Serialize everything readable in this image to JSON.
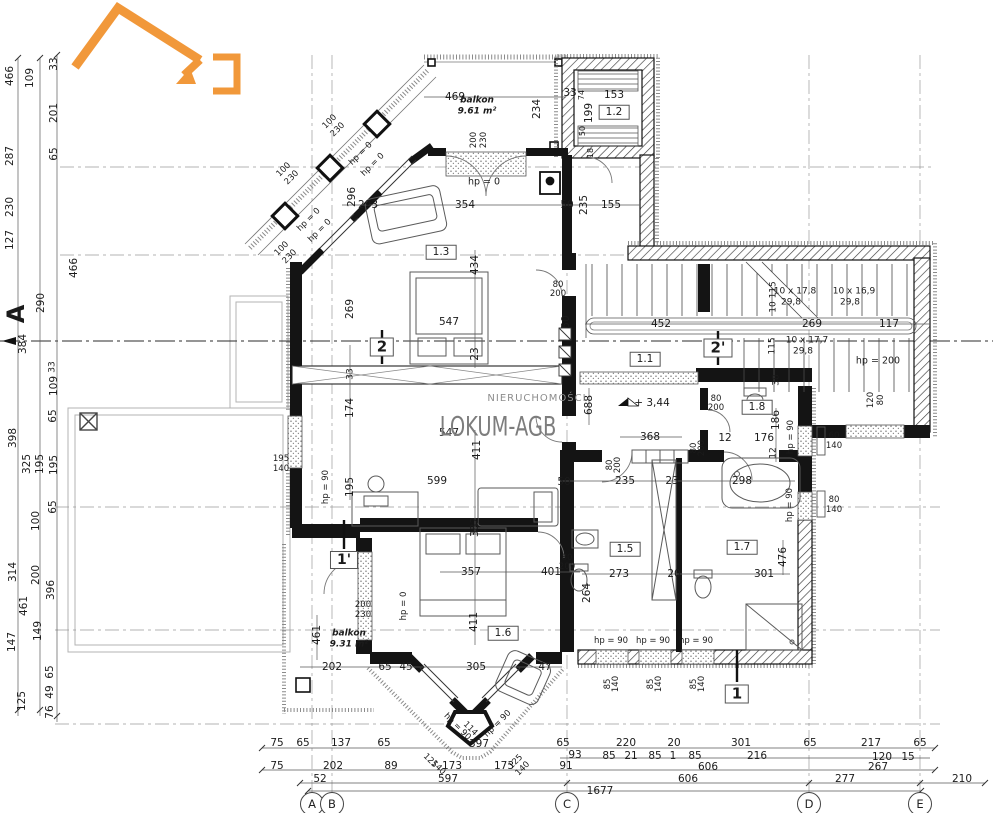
{
  "drawing": {
    "type": "apartment floor plan",
    "brand": {
      "name": "LOKUM-AGB",
      "subtitle": "NIERUCHOMOŚCI",
      "accent_color": "#f08a1f"
    },
    "grid_bubbles": [
      {
        "t": "A",
        "x": 312
      },
      {
        "t": "B",
        "x": 332
      },
      {
        "t": "C",
        "x": 567
      },
      {
        "t": "D",
        "x": 809
      },
      {
        "t": "E",
        "x": 920
      }
    ],
    "grid_bubble_y": 804,
    "labels": [
      {
        "t": "469",
        "x": 455,
        "y": 97
      },
      {
        "t": "234",
        "x": 537,
        "y": 109,
        "r": -90
      },
      {
        "t": "33",
        "x": 570,
        "y": 93
      },
      {
        "t": "74",
        "x": 582,
        "y": 95,
        "r": -90,
        "s": 8
      },
      {
        "t": "153",
        "x": 614,
        "y": 95
      },
      {
        "t": "199",
        "x": 589,
        "y": 113,
        "r": -90
      },
      {
        "t": "50",
        "x": 583,
        "y": 131,
        "r": -90,
        "s": 8
      },
      {
        "t": "18",
        "x": 591,
        "y": 153,
        "r": -90,
        "s": 8
      },
      {
        "t": "balkon",
        "x": 477,
        "y": 101,
        "b": 1,
        "i": 1,
        "s": 9,
        "n": "balcony-label"
      },
      {
        "t": "9.61 m²",
        "x": 477,
        "y": 112,
        "b": 1,
        "i": 1,
        "s": 9,
        "n": "balcony-area"
      },
      {
        "t": "200",
        "x": 474,
        "y": 140,
        "r": -90,
        "s": 8.5
      },
      {
        "t": "230",
        "x": 484,
        "y": 140,
        "r": -90,
        "s": 8.5
      },
      {
        "t": "hp = 0",
        "x": 484,
        "y": 182,
        "s": 9.5
      },
      {
        "t": "296",
        "x": 352,
        "y": 197,
        "r": -90
      },
      {
        "t": "293",
        "x": 368,
        "y": 205
      },
      {
        "t": "354",
        "x": 465,
        "y": 205
      },
      {
        "t": "50",
        "x": 567,
        "y": 205
      },
      {
        "t": "235",
        "x": 584,
        "y": 205,
        "r": -90
      },
      {
        "t": "155",
        "x": 611,
        "y": 205
      },
      {
        "t": "100",
        "x": 330,
        "y": 122,
        "r": -45,
        "s": 8.5
      },
      {
        "t": "230",
        "x": 338,
        "y": 130,
        "r": -45,
        "s": 8.5
      },
      {
        "t": "100",
        "x": 284,
        "y": 170,
        "r": -45,
        "s": 8.5
      },
      {
        "t": "230",
        "x": 292,
        "y": 178,
        "r": -45,
        "s": 8.5
      },
      {
        "t": "100",
        "x": 282,
        "y": 249,
        "r": -45,
        "s": 8.5
      },
      {
        "t": "230",
        "x": 290,
        "y": 257,
        "r": -45,
        "s": 8.5
      },
      {
        "t": "hp = 0",
        "x": 361,
        "y": 154,
        "r": -45,
        "s": 8.5
      },
      {
        "t": "hp = 0",
        "x": 373,
        "y": 165,
        "r": -45,
        "s": 8.5
      },
      {
        "t": "hp = 0",
        "x": 309,
        "y": 220,
        "r": -45,
        "s": 8.5
      },
      {
        "t": "hp = 0",
        "x": 320,
        "y": 231,
        "r": -45,
        "s": 8.5
      },
      {
        "t": "1.3",
        "x": 441,
        "y": 252,
        "box": 1,
        "n": "room-label"
      },
      {
        "t": "434",
        "x": 475,
        "y": 265,
        "r": -90
      },
      {
        "t": "269",
        "x": 350,
        "y": 309,
        "r": -90
      },
      {
        "t": "547",
        "x": 449,
        "y": 322
      },
      {
        "t": "23",
        "x": 475,
        "y": 354,
        "r": -90
      },
      {
        "t": "80",
        "x": 558,
        "y": 285,
        "s": 8.5
      },
      {
        "t": "200",
        "x": 558,
        "y": 294,
        "s": 8.5
      },
      {
        "t": "50",
        "x": 566,
        "y": 322,
        "r": -90
      },
      {
        "t": "452",
        "x": 661,
        "y": 324
      },
      {
        "t": "10 x 17,8",
        "x": 795,
        "y": 292,
        "s": 9,
        "n": "stair-note"
      },
      {
        "t": "29,8",
        "x": 791,
        "y": 303,
        "s": 9,
        "n": "stair-note"
      },
      {
        "t": "10 x 16,9",
        "x": 854,
        "y": 292,
        "s": 9,
        "n": "stair-note"
      },
      {
        "t": "29,8",
        "x": 850,
        "y": 303,
        "s": 9,
        "n": "stair-note"
      },
      {
        "t": "10 115",
        "x": 774,
        "y": 297,
        "r": -90,
        "s": 9
      },
      {
        "t": "269",
        "x": 812,
        "y": 324
      },
      {
        "t": "117",
        "x": 889,
        "y": 324
      },
      {
        "t": "10 x 17,7",
        "x": 807,
        "y": 341,
        "s": 9,
        "n": "stair-note"
      },
      {
        "t": "29,8",
        "x": 803,
        "y": 352,
        "s": 9,
        "n": "stair-note"
      },
      {
        "t": "115",
        "x": 773,
        "y": 346,
        "r": -90,
        "s": 9
      },
      {
        "t": "hp = 200",
        "x": 878,
        "y": 361,
        "s": 9.5
      },
      {
        "t": "38",
        "x": 777,
        "y": 380,
        "r": -90,
        "s": 9
      },
      {
        "t": "120",
        "x": 871,
        "y": 400,
        "r": -90,
        "s": 8.5
      },
      {
        "t": "80",
        "x": 881,
        "y": 400,
        "r": -90,
        "s": 8.5
      },
      {
        "t": "1.1",
        "x": 645,
        "y": 359,
        "box": 1,
        "n": "room-label"
      },
      {
        "t": "1.2",
        "x": 614,
        "y": 112,
        "box": 1,
        "n": "room-label"
      },
      {
        "t": "2",
        "x": 382,
        "y": 347,
        "b": 1,
        "s": 15,
        "box": 1,
        "n": "section-marker"
      },
      {
        "t": "2'",
        "x": 718,
        "y": 348,
        "b": 1,
        "s": 15,
        "box": 1,
        "n": "section-marker"
      },
      {
        "t": "A",
        "x": 16,
        "y": 314,
        "r": -90,
        "s": 24,
        "b": 1,
        "n": "axis-label"
      },
      {
        "t": "290",
        "x": 41,
        "y": 303,
        "r": -90
      },
      {
        "t": "384",
        "x": 23,
        "y": 344,
        "r": -90
      },
      {
        "t": "33",
        "x": 53,
        "y": 367,
        "r": -90,
        "s": 9
      },
      {
        "t": "109",
        "x": 54,
        "y": 386,
        "r": -90
      },
      {
        "t": "65",
        "x": 53,
        "y": 416,
        "r": -90
      },
      {
        "t": "466",
        "x": 10,
        "y": 76,
        "r": -90
      },
      {
        "t": "109",
        "x": 30,
        "y": 78,
        "r": -90
      },
      {
        "t": "33",
        "x": 54,
        "y": 64,
        "r": -90
      },
      {
        "t": "201",
        "x": 54,
        "y": 113,
        "r": -90
      },
      {
        "t": "287",
        "x": 10,
        "y": 156,
        "r": -90
      },
      {
        "t": "65",
        "x": 54,
        "y": 154,
        "r": -90
      },
      {
        "t": "230",
        "x": 10,
        "y": 207,
        "r": -90
      },
      {
        "t": "127",
        "x": 10,
        "y": 240,
        "r": -90
      },
      {
        "t": "466",
        "x": 74,
        "y": 268,
        "r": -90
      },
      {
        "t": "398",
        "x": 13,
        "y": 438,
        "r": -90
      },
      {
        "t": "325",
        "x": 27,
        "y": 464,
        "r": -90
      },
      {
        "t": "195",
        "x": 40,
        "y": 464,
        "r": -90
      },
      {
        "t": "195",
        "x": 54,
        "y": 465,
        "r": -90
      },
      {
        "t": "65",
        "x": 53,
        "y": 507,
        "r": -90
      },
      {
        "t": "100",
        "x": 36,
        "y": 521,
        "r": -90
      },
      {
        "t": "314",
        "x": 13,
        "y": 572,
        "r": -90
      },
      {
        "t": "200",
        "x": 36,
        "y": 575,
        "r": -90
      },
      {
        "t": "396",
        "x": 51,
        "y": 590,
        "r": -90
      },
      {
        "t": "461",
        "x": 24,
        "y": 606,
        "r": -90
      },
      {
        "t": "149",
        "x": 38,
        "y": 631,
        "r": -90
      },
      {
        "t": "147",
        "x": 12,
        "y": 642,
        "r": -90
      },
      {
        "t": "65",
        "x": 50,
        "y": 672,
        "r": -90
      },
      {
        "t": "49",
        "x": 50,
        "y": 692,
        "r": -90
      },
      {
        "t": "125",
        "x": 22,
        "y": 701,
        "r": -90
      },
      {
        "t": "76",
        "x": 50,
        "y": 712,
        "r": -90
      },
      {
        "t": "688",
        "x": 589,
        "y": 405,
        "r": -90
      },
      {
        "t": "+ 3,44",
        "x": 652,
        "y": 403,
        "n": "level-mark"
      },
      {
        "t": "368",
        "x": 650,
        "y": 437
      },
      {
        "t": "80",
        "x": 716,
        "y": 399,
        "s": 8.5
      },
      {
        "t": "200",
        "x": 716,
        "y": 408,
        "s": 8.5
      },
      {
        "t": "1.8",
        "x": 757,
        "y": 407,
        "box": 1,
        "n": "room-label"
      },
      {
        "t": "186",
        "x": 776,
        "y": 420,
        "r": -90
      },
      {
        "t": "12",
        "x": 725,
        "y": 438
      },
      {
        "t": "176",
        "x": 764,
        "y": 438
      },
      {
        "t": "12",
        "x": 774,
        "y": 453,
        "r": -90,
        "s": 9
      },
      {
        "t": "hp = 90",
        "x": 791,
        "y": 437,
        "r": -90,
        "s": 8.5
      },
      {
        "t": "60",
        "x": 834,
        "y": 436,
        "s": 8.5
      },
      {
        "t": "140",
        "x": 834,
        "y": 446,
        "s": 8.5
      },
      {
        "t": "80",
        "x": 834,
        "y": 500,
        "s": 8.5
      },
      {
        "t": "140",
        "x": 834,
        "y": 510,
        "s": 8.5
      },
      {
        "t": "hp = 90",
        "x": 790,
        "y": 505,
        "r": -90,
        "s": 8.5
      },
      {
        "t": "80",
        "x": 694,
        "y": 448,
        "r": -90,
        "s": 8.5
      },
      {
        "t": "200",
        "x": 702,
        "y": 448,
        "r": -90,
        "s": 8.5
      },
      {
        "t": "80",
        "x": 610,
        "y": 465,
        "r": -90,
        "s": 8.5
      },
      {
        "t": "200",
        "x": 618,
        "y": 465,
        "r": -90,
        "s": 8.5
      },
      {
        "t": "50",
        "x": 564,
        "y": 482
      },
      {
        "t": "235",
        "x": 625,
        "y": 481
      },
      {
        "t": "23",
        "x": 672,
        "y": 481
      },
      {
        "t": "298",
        "x": 742,
        "y": 481
      },
      {
        "t": "599",
        "x": 437,
        "y": 481
      },
      {
        "t": "195",
        "x": 350,
        "y": 487,
        "r": -90
      },
      {
        "t": "hp = 90",
        "x": 326,
        "y": 487,
        "r": -90,
        "s": 8.5
      },
      {
        "t": "195",
        "x": 281,
        "y": 459,
        "s": 8.5
      },
      {
        "t": "140",
        "x": 281,
        "y": 469,
        "s": 8.5
      },
      {
        "t": "174",
        "x": 350,
        "y": 408,
        "r": -90
      },
      {
        "t": "33",
        "x": 351,
        "y": 374,
        "r": -90,
        "s": 9
      },
      {
        "t": "547",
        "x": 449,
        "y": 433
      },
      {
        "t": "411",
        "x": 477,
        "y": 450,
        "r": -90
      },
      {
        "t": "1'",
        "x": 344,
        "y": 560,
        "b": 1,
        "s": 14,
        "box": 1,
        "n": "section-marker"
      },
      {
        "t": "200",
        "x": 363,
        "y": 605,
        "s": 8.5
      },
      {
        "t": "230",
        "x": 363,
        "y": 615,
        "s": 8.5
      },
      {
        "t": "hp = 0",
        "x": 404,
        "y": 606,
        "r": -90,
        "s": 8.5
      },
      {
        "t": "382",
        "x": 475,
        "y": 527,
        "r": -90
      },
      {
        "t": "357",
        "x": 471,
        "y": 572
      },
      {
        "t": "401",
        "x": 551,
        "y": 572
      },
      {
        "t": "80",
        "x": 567,
        "y": 558,
        "s": 8.5
      },
      {
        "t": "200",
        "x": 567,
        "y": 567,
        "s": 8.5
      },
      {
        "t": "264",
        "x": 587,
        "y": 593,
        "r": -90
      },
      {
        "t": "1.6",
        "x": 503,
        "y": 633,
        "box": 1,
        "n": "room-label"
      },
      {
        "t": "411",
        "x": 474,
        "y": 622,
        "r": -90
      },
      {
        "t": "461",
        "x": 317,
        "y": 635,
        "r": -90
      },
      {
        "t": "balkon",
        "x": 349,
        "y": 634,
        "b": 1,
        "i": 1,
        "s": 9,
        "n": "balcony-label"
      },
      {
        "t": "9.31 m²",
        "x": 349,
        "y": 645,
        "b": 1,
        "i": 1,
        "s": 9,
        "n": "balcony-area"
      },
      {
        "t": "202",
        "x": 332,
        "y": 667
      },
      {
        "t": "65",
        "x": 385,
        "y": 667
      },
      {
        "t": "45",
        "x": 406,
        "y": 667
      },
      {
        "t": "305",
        "x": 476,
        "y": 667
      },
      {
        "t": "47",
        "x": 545,
        "y": 667
      },
      {
        "t": "hp = 90",
        "x": 457,
        "y": 727,
        "r": 45,
        "s": 8.5
      },
      {
        "t": "114",
        "x": 470,
        "y": 729,
        "r": 45,
        "s": 8.5
      },
      {
        "t": "hp = 90",
        "x": 498,
        "y": 724,
        "r": -45,
        "s": 8.5
      },
      {
        "t": "397",
        "x": 479,
        "y": 744
      },
      {
        "t": "125",
        "x": 430,
        "y": 761,
        "r": 45,
        "s": 8.5
      },
      {
        "t": "140",
        "x": 438,
        "y": 768,
        "r": 45,
        "s": 8.5
      },
      {
        "t": "125",
        "x": 516,
        "y": 762,
        "r": -45,
        "s": 8.5
      },
      {
        "t": "140",
        "x": 523,
        "y": 769,
        "r": -45,
        "s": 8.5
      },
      {
        "t": "273",
        "x": 619,
        "y": 574
      },
      {
        "t": "20",
        "x": 674,
        "y": 574
      },
      {
        "t": "301",
        "x": 764,
        "y": 574
      },
      {
        "t": "476",
        "x": 783,
        "y": 557,
        "r": -90
      },
      {
        "t": "1.5",
        "x": 625,
        "y": 549,
        "box": 1,
        "n": "room-label"
      },
      {
        "t": "1.7",
        "x": 742,
        "y": 547,
        "box": 1,
        "n": "room-label"
      },
      {
        "t": "hp = 90",
        "x": 611,
        "y": 641,
        "s": 8.5
      },
      {
        "t": "hp = 90",
        "x": 653,
        "y": 641,
        "s": 8.5
      },
      {
        "t": "hp = 90",
        "x": 696,
        "y": 641,
        "s": 8.5
      },
      {
        "t": "85",
        "x": 608,
        "y": 684,
        "r": -90,
        "s": 8.5
      },
      {
        "t": "140",
        "x": 616,
        "y": 684,
        "r": -90,
        "s": 8.5
      },
      {
        "t": "85",
        "x": 651,
        "y": 684,
        "r": -90,
        "s": 8.5
      },
      {
        "t": "140",
        "x": 659,
        "y": 684,
        "r": -90,
        "s": 8.5
      },
      {
        "t": "85",
        "x": 694,
        "y": 684,
        "r": -90,
        "s": 8.5
      },
      {
        "t": "140",
        "x": 702,
        "y": 684,
        "r": -90,
        "s": 8.5
      },
      {
        "t": "1",
        "x": 737,
        "y": 694,
        "b": 1,
        "s": 15,
        "box": 1,
        "n": "section-marker"
      },
      {
        "t": "75",
        "x": 277,
        "y": 743
      },
      {
        "t": "65",
        "x": 303,
        "y": 743
      },
      {
        "t": "137",
        "x": 341,
        "y": 743
      },
      {
        "t": "65",
        "x": 384,
        "y": 743
      },
      {
        "t": "65",
        "x": 563,
        "y": 743
      },
      {
        "t": "220",
        "x": 626,
        "y": 743
      },
      {
        "t": "20",
        "x": 674,
        "y": 743
      },
      {
        "t": "301",
        "x": 741,
        "y": 743
      },
      {
        "t": "65",
        "x": 810,
        "y": 743
      },
      {
        "t": "217",
        "x": 871,
        "y": 743
      },
      {
        "t": "65",
        "x": 920,
        "y": 743
      },
      {
        "t": "93",
        "x": 575,
        "y": 755
      },
      {
        "t": "85",
        "x": 609,
        "y": 756
      },
      {
        "t": "21",
        "x": 631,
        "y": 756
      },
      {
        "t": "85",
        "x": 655,
        "y": 756
      },
      {
        "t": "1",
        "x": 673,
        "y": 756
      },
      {
        "t": "85",
        "x": 695,
        "y": 756
      },
      {
        "t": "216",
        "x": 757,
        "y": 756
      },
      {
        "t": "120",
        "x": 882,
        "y": 757
      },
      {
        "t": "15",
        "x": 908,
        "y": 757
      },
      {
        "t": "75",
        "x": 277,
        "y": 766
      },
      {
        "t": "202",
        "x": 333,
        "y": 766
      },
      {
        "t": "89",
        "x": 391,
        "y": 766
      },
      {
        "t": "173",
        "x": 452,
        "y": 766
      },
      {
        "t": "173",
        "x": 504,
        "y": 766
      },
      {
        "t": "91",
        "x": 566,
        "y": 766
      },
      {
        "t": "52",
        "x": 320,
        "y": 779
      },
      {
        "t": "597",
        "x": 448,
        "y": 779
      },
      {
        "t": "606",
        "x": 708,
        "y": 767
      },
      {
        "t": "267",
        "x": 878,
        "y": 767
      },
      {
        "t": "606",
        "x": 688,
        "y": 779
      },
      {
        "t": "277",
        "x": 845,
        "y": 779
      },
      {
        "t": "210",
        "x": 962,
        "y": 779
      },
      {
        "t": "1677",
        "x": 600,
        "y": 791
      },
      {
        "t": "NIERUCHOMOŚCI",
        "x": 537,
        "y": 399,
        "s": 10,
        "c": "#8d8d8d",
        "ls": 1,
        "n": "brand-subtitle"
      },
      {
        "t": "LOKUM-AGB",
        "x": 498,
        "y": 427,
        "s": 27,
        "c": "#7d7d7d",
        "sx": 0.72,
        "n": "brand-name"
      }
    ]
  }
}
